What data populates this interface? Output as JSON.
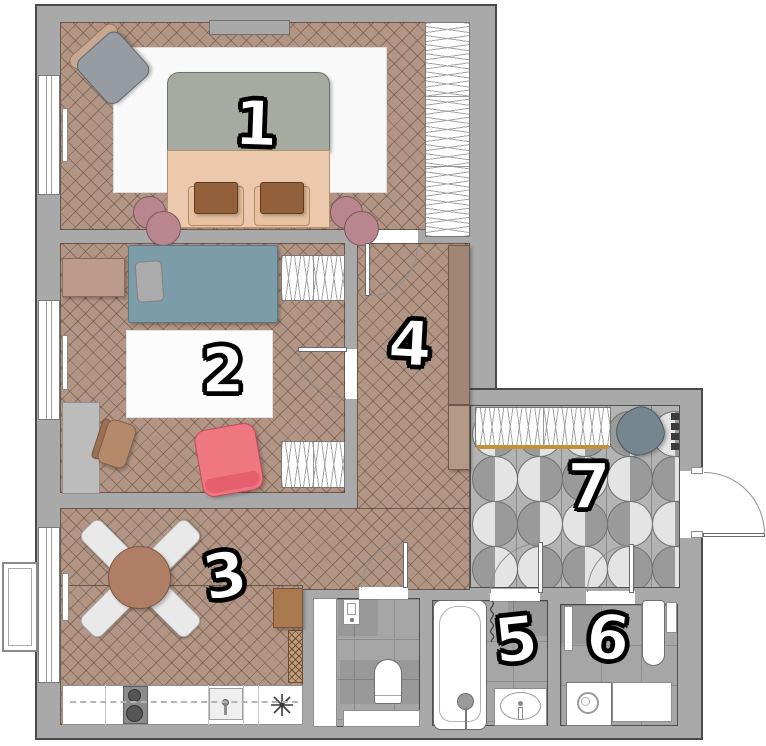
{
  "rooms": [
    {
      "number": "1"
    },
    {
      "number": "2"
    },
    {
      "number": "3"
    },
    {
      "number": "4"
    },
    {
      "number": "5"
    },
    {
      "number": "6"
    },
    {
      "number": "7"
    }
  ],
  "palette": {
    "wall": "#a9a9a9",
    "wood": "#b29584",
    "tile": "#a6a6a6",
    "entry": "#b3b3b3",
    "circle_light": "#e4e4e4",
    "circle_dark": "#9a9a9a",
    "gold": "#c3913c",
    "blanket": "#a6aaa0",
    "sheet": "#ecc9ac",
    "pillow_brown": "#93603c",
    "teal": "#7d9ca9",
    "pink": "#ee7780",
    "pouf": "#b9868f",
    "table": "#b07e66",
    "slate": "#76868e",
    "cabinet_tan": "#a98775"
  }
}
